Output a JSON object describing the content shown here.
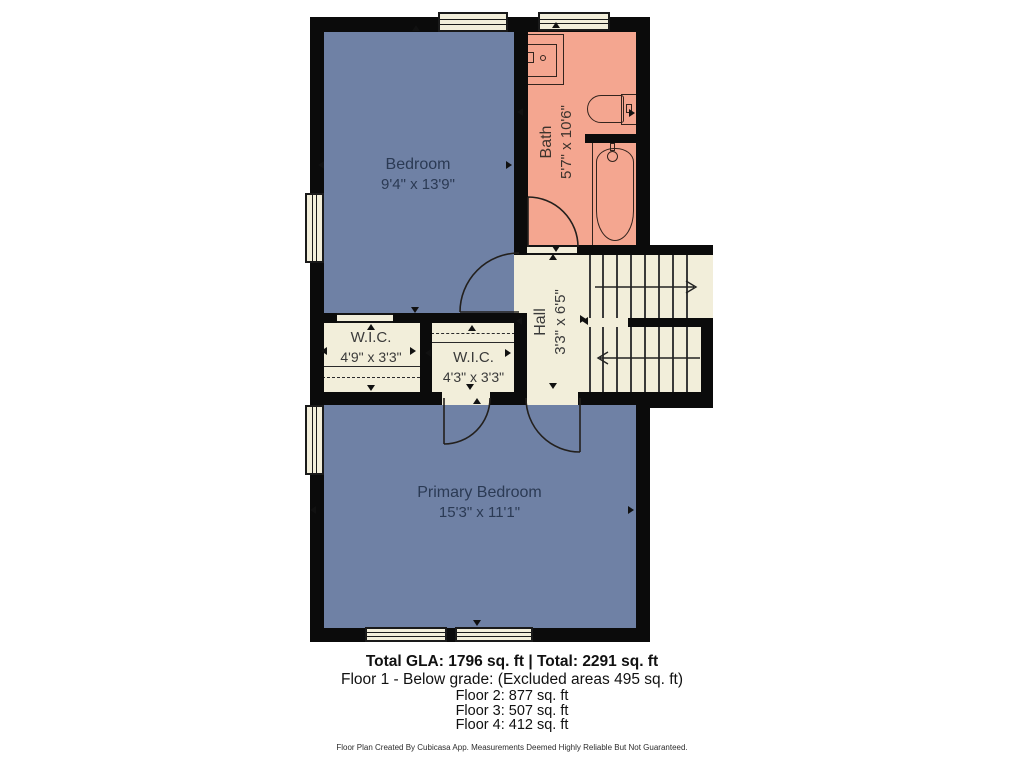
{
  "plan": {
    "rooms": {
      "bedroom": {
        "name": "Bedroom",
        "dims": "9'4\" x 13'9\""
      },
      "bath": {
        "name": "Bath",
        "dims": "5'7\" x 10'6\""
      },
      "wic_left": {
        "name": "W.I.C.",
        "dims": "4'9\" x 3'3\""
      },
      "wic_middle": {
        "name": "W.I.C.",
        "dims": "4'3\" x 3'3\""
      },
      "hall": {
        "name": "Hall",
        "dims": "3'3\" x 6'5\""
      },
      "primary_bedroom": {
        "name": "Primary Bedroom",
        "dims": "15'3\" x 11'1\""
      }
    },
    "fixtures": [
      "sink-icon",
      "toilet-icon",
      "bathtub-icon"
    ],
    "stairs": {
      "upper_flight_direction": "right",
      "lower_flight_direction": "left"
    }
  },
  "summary": {
    "total_line": "Total GLA: 1796 sq. ft | Total: 2291 sq. ft",
    "floor1": "Floor 1 - Below grade: (Excluded areas 495 sq. ft)",
    "floor2": "Floor 2: 877 sq. ft",
    "floor3": "Floor 3: 507 sq. ft",
    "floor4": "Floor 4: 412 sq. ft"
  },
  "footer": "Floor Plan Created By Cubicasa App. Measurements Deemed Highly Reliable But Not Guaranteed.",
  "colors": {
    "room_blue": "#6F81A5",
    "bath_pink": "#F4A690",
    "floor_cream": "#F2EEDA",
    "wall_black": "#0B0B0B"
  }
}
